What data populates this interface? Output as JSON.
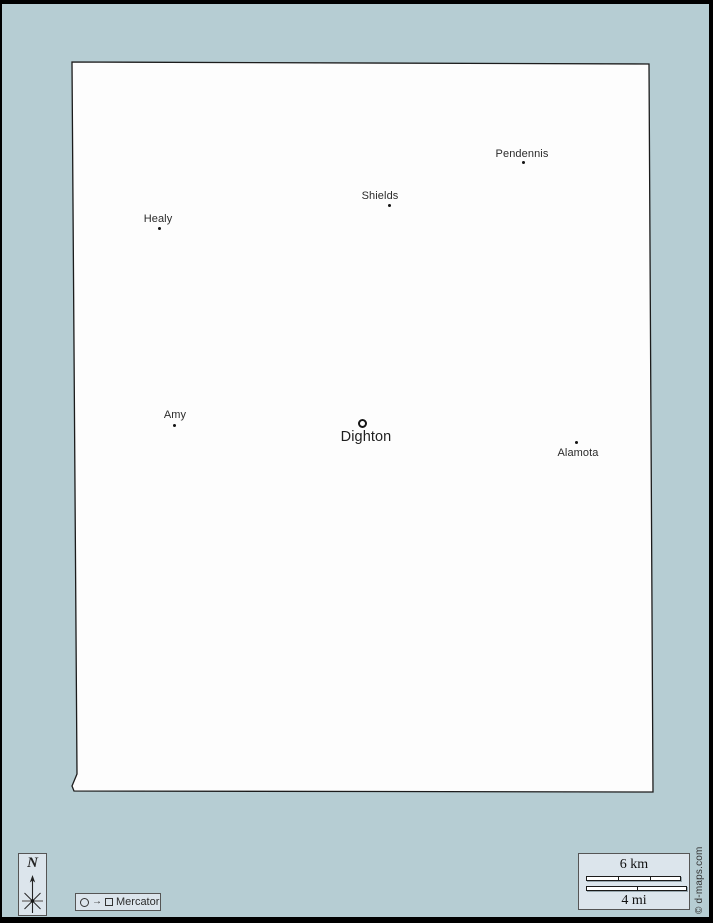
{
  "colors": {
    "background": "#b6cdd3",
    "panel": "#dce5ec",
    "map_fill": "#fdfdfd",
    "outline": "#1c1c1c",
    "label": "#2b2b2b"
  },
  "map": {
    "cities": [
      {
        "name": "Healy"
      },
      {
        "name": "Shields"
      },
      {
        "name": "Pendennis"
      },
      {
        "name": "Amy"
      },
      {
        "name": "Alamota"
      }
    ],
    "county_seat": {
      "name": "Dighton"
    }
  },
  "compass": {
    "label": "N"
  },
  "projection": {
    "arrow": "→",
    "label": "Mercator"
  },
  "scale": {
    "km": "6 km",
    "mi": "4 mi"
  },
  "credit": "© d-maps.com"
}
